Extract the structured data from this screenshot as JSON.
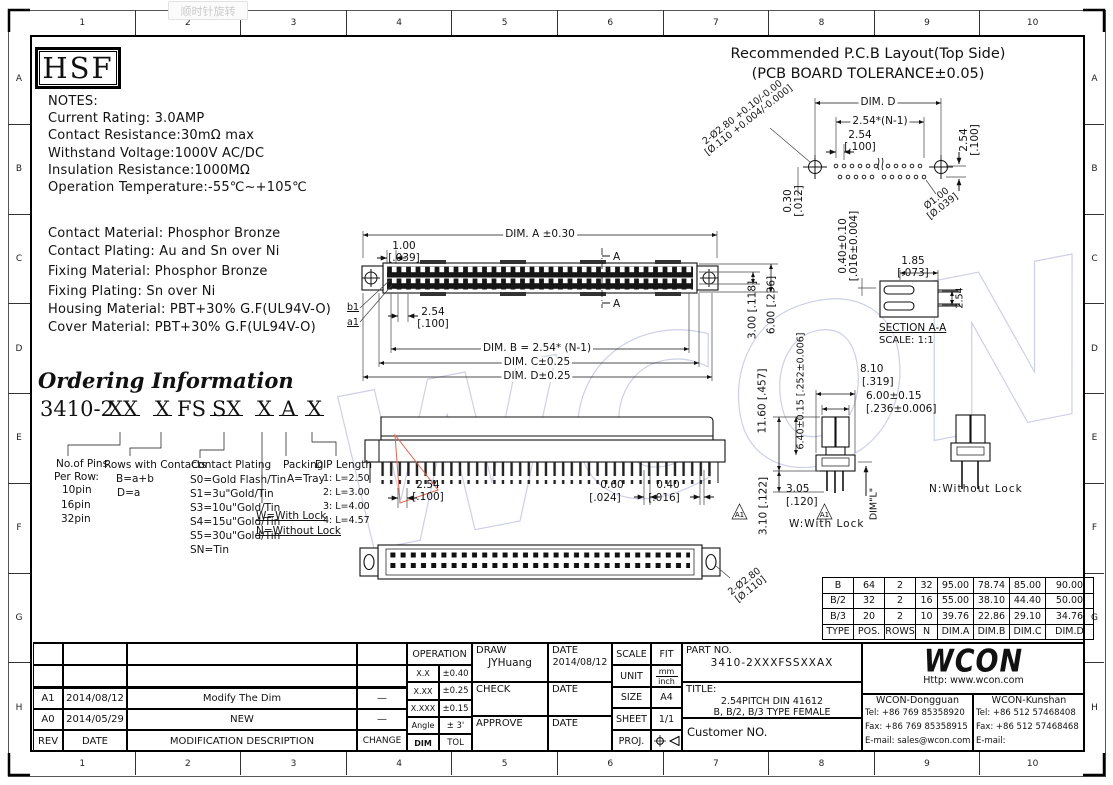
{
  "viewer": {
    "rotate_tooltip": "顺时针旋转"
  },
  "frame": {
    "cols": [
      "1",
      "2",
      "3",
      "4",
      "5",
      "6",
      "7",
      "8",
      "9",
      "10"
    ],
    "rows": [
      "A",
      "B",
      "C",
      "D",
      "E",
      "F",
      "G",
      "H"
    ]
  },
  "logo_hsf": "HSF",
  "notes": {
    "title": "NOTES:",
    "line1": "Current Rating: 3.0AMP",
    "line2": "Contact Resistance:30mΩ max",
    "line3": "Withstand Voltage:1000V AC/DC",
    "line4": "Insulation Resistance:1000MΩ",
    "line5": "Operation Temperature:-55℃~+105℃"
  },
  "materials": {
    "line1": "Contact Material: Phosphor Bronze",
    "line2": "Contact Plating: Au and Sn over Ni",
    "line3": "Fixing Material: Phosphor Bronze",
    "line4": "Fixing Plating: Sn over Ni",
    "line5": "Housing Material: PBT+30% G.F(UL94V-O)",
    "line6": "Cover Material: PBT+30% G.F(UL94V-O)"
  },
  "ordering": {
    "title": "Ordering Information",
    "code_base": "3410-2",
    "code_pins": "XX",
    "code_rows": "X",
    "code_fs": "FS",
    "code_plating": "SX",
    "code_lock": "X",
    "code_packing": "A",
    "code_dip": "X",
    "pins_title1": "No.of Pins",
    "pins_title2": "Per Row:",
    "pins_1": "10pin",
    "pins_2": "16pin",
    "pins_3": "32pin",
    "rows_title": "Rows with Contacts",
    "rows_1": "B=a+b",
    "rows_2": "D=a",
    "plating_title": "Contact Plating",
    "plating_1": "S0=Gold Flash/Tin",
    "plating_2": "S1=3u\"Gold/Tin",
    "plating_3": "S3=10u\"Gold/Tin",
    "plating_4": "S4=15u\"Gold/Tin",
    "plating_5": "S5=30u\"Gold/Tin",
    "plating_6": "SN=Tin",
    "lock_1": "W=With Lock",
    "lock_2": "N=Without Lock",
    "packing_title": "Packing",
    "packing_1": "A=Tray",
    "dip_title": "DIP Length",
    "dip_1": "1: L=2.50",
    "dip_2": "2: L=3.00",
    "dip_3": "3: L=4.00",
    "dip_4": "4: L=4.57"
  },
  "pcb": {
    "title1": "Recommended P.C.B Layout(Top Side)",
    "title2": "(PCB BOARD TOLERANCE±0.05)",
    "dim_d": "DIM. D",
    "pitch_n": "2.54*(N-1)",
    "pitch_mm": "2.54",
    "pitch_in": "[.100]",
    "row_pitch_mm": "2.54",
    "row_pitch_in": "[.100]",
    "offset_mm": "0.30",
    "offset_in": "[.012]",
    "hole_mm": "2-Ø2.80 +0.10/-0.00",
    "hole_in": "[Ø.110 +0.004/-0.000]",
    "via_mm": "Ø1.00",
    "via_in": "[Ø.039]"
  },
  "top_view": {
    "dim_a": "DIM. A ±0.30",
    "lead_mm": "1.00",
    "lead_in": "[.039]",
    "pitch_mm": "2.54",
    "pitch_in": "[.100]",
    "dim_b": "DIM. B = 2.54* (N-1)",
    "dim_c": "DIM. C±0.25",
    "dim_d": "DIM. D±0.25",
    "row_b1": "b1",
    "row_a1": "a1",
    "sec_a_top": "A",
    "sec_a_bot": "A",
    "h_rows": "3.00 [.118]",
    "h_body": "6.00 [.236]"
  },
  "section": {
    "tol1": "0.40±0.10",
    "tol2": "[.016±0.004]",
    "w_mm": "1.85",
    "w_in": "[.073]",
    "pitch": "2.54",
    "title": "SECTION A-A",
    "scale": "SCALE: 1:1"
  },
  "side_view": {
    "pitch_mm": "2.54",
    "pitch_in": "[.100]",
    "pin1_mm": "0.60",
    "pin1_in": "[.024]",
    "pin2_mm": "0.40",
    "pin2_in": "[.016]"
  },
  "lock_views": {
    "w810_mm": "8.10",
    "w810_in": "[.319]",
    "w600_mm": "6.00±0.15",
    "w600_in": "[.236±0.006]",
    "h1160": "11.60 [.457]",
    "h640": "6.40±0.15 [.252±0.006]",
    "h310": "3.10 [.122]",
    "p305_mm": "3.05",
    "p305_in": "[.120]",
    "dim_l": "DIM\"L\"",
    "rev1": "A1",
    "rev2": "A1",
    "w_label": "W:With Lock",
    "n_label": "N:Without Lock"
  },
  "bottom_view": {
    "hole_mm": "2-Ø2.80",
    "hole_in": "[Ø.110]"
  },
  "size_table": {
    "h": [
      "TYPE",
      "POS.",
      "ROWS",
      "N",
      "DIM.A",
      "DIM.B",
      "DIM.C",
      "DIM.D"
    ],
    "r1": [
      "B",
      "64",
      "2",
      "32",
      "95.00",
      "78.74",
      "85.00",
      "90.00"
    ],
    "r2": [
      "B/2",
      "32",
      "2",
      "16",
      "55.00",
      "38.10",
      "44.40",
      "50.00"
    ],
    "r3": [
      "B/3",
      "20",
      "2",
      "10",
      "39.76",
      "22.86",
      "29.10",
      "34.76"
    ]
  },
  "revisions": {
    "h_rev": "REV",
    "h_date": "DATE",
    "h_desc": "MODIFICATION  DESCRIPTION",
    "h_change": "CHANGE",
    "r1_rev": "A1",
    "r1_date": "2014/08/12",
    "r1_desc": "Modify The Dim",
    "r1_change": "—",
    "r2_rev": "A0",
    "r2_date": "2014/05/29",
    "r2_desc": "NEW",
    "r2_change": "—"
  },
  "tolerance_block": {
    "title": "OPERATION",
    "l1": "X.X",
    "v1": "±0.40",
    "l2": "X.XX",
    "v2": "±0.25",
    "l3": "X.XXX",
    "v3": "±0.15",
    "l4": "Angle",
    "v4": "± 3'",
    "l5": "DIM",
    "v5": "TOL"
  },
  "approvals": {
    "draw": "DRAW",
    "draw_name": "JYHuang",
    "date1": "DATE",
    "draw_date": "2014/08/12",
    "check": "CHECK",
    "date2": "DATE",
    "approve": "APPROVE",
    "date3": "DATE"
  },
  "meta": {
    "scale_l": "SCALE",
    "scale_v": "FIT",
    "unit_l": "UNIT",
    "unit_top": "mm",
    "unit_bot": "inch",
    "size_l": "SIZE",
    "size_v": "A4",
    "sheet_l": "SHEET",
    "sheet_v": "1/1",
    "proj_l": "PROJ."
  },
  "part": {
    "no_label": "PART NO.",
    "no": "3410-2XXXFSSXXAX",
    "title_label": "TITLE:",
    "title1": "2.54PITCH DIN 41612",
    "title2": "B, B/2, B/3 TYPE FEMALE",
    "customer": "Customer NO."
  },
  "company": {
    "logo": "WCON",
    "url": "Http: www.wcon.com",
    "dg_name": "WCON-Dongguan",
    "dg_tel": "Tel: +86 769 85358920",
    "dg_fax": "Fax: +86 769 85358915",
    "dg_mail": "E-mail: sales@wcon.com",
    "ks_name": "WCON-Kunshan",
    "ks_tel": "Tel: +86 512 57468408",
    "ks_fax": "Fax: +86 512 57468468",
    "ks_mail": "E-mail: salesks@wcon.com"
  },
  "watermark": "WCON"
}
